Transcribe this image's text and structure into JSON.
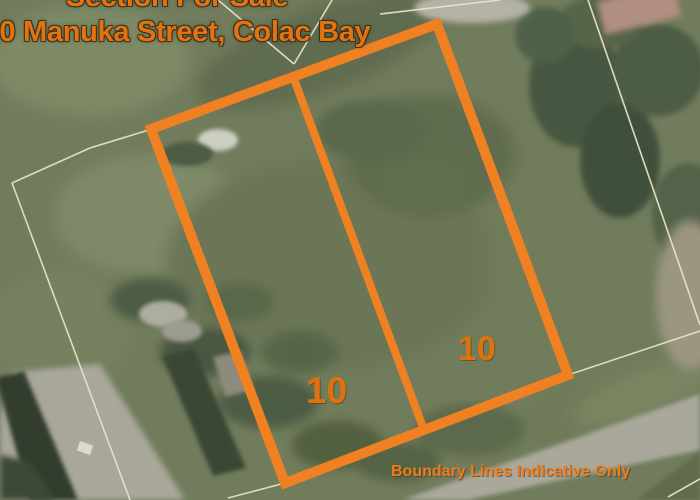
{
  "listing": {
    "heading": "Section For Sale",
    "address": "10 Manuka Street, Colac Bay",
    "disclaimer": "Boundary Lines Indicative Only"
  },
  "parcels": [
    {
      "label": "10",
      "position": "left"
    },
    {
      "label": "10",
      "position": "right"
    }
  ],
  "colors": {
    "boundary_orange": "#F08122",
    "overlay_text_orange": "#E4730E",
    "cadastral_line_cream": "#E9E2C2",
    "grass_base": "#717C5C",
    "road_gray": "#A9A89B"
  }
}
